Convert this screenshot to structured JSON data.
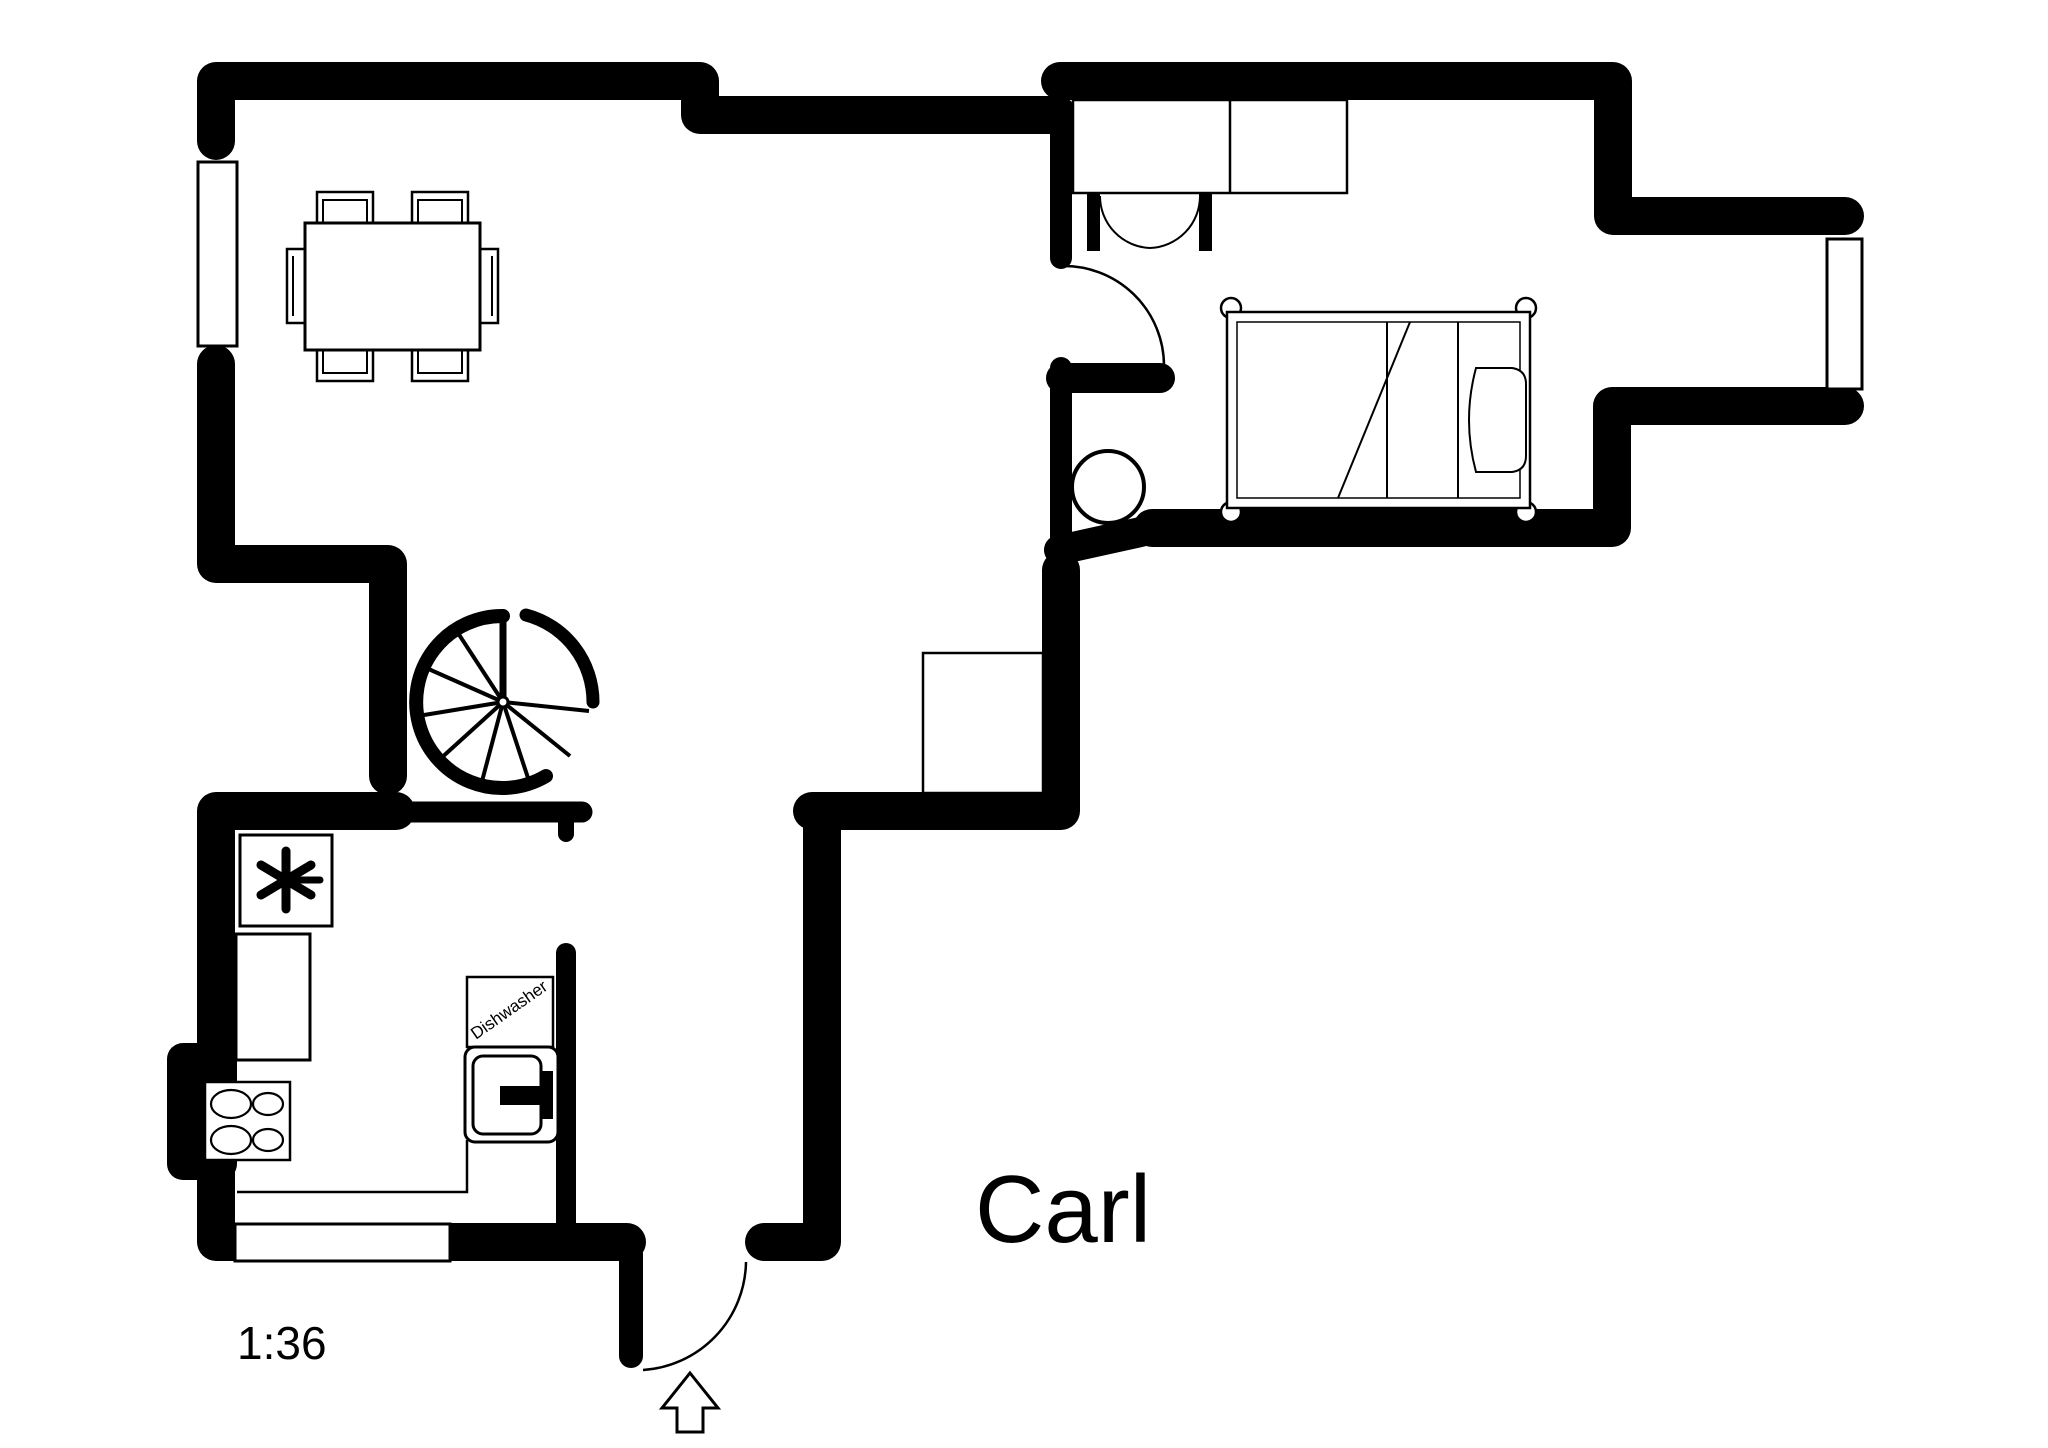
{
  "plan": {
    "title": "Carl",
    "scale": "1:36",
    "dishwasher_label": "Dishwasher",
    "colors": {
      "walls": "#000000",
      "background": "#ffffff"
    },
    "symbols": [
      "dining-table",
      "dining-chairs",
      "spiral-staircase",
      "single-bed",
      "wardrobe-double-doors",
      "round-basin",
      "cooktop-4-burners",
      "freezer-asterisk",
      "dishwasher",
      "entrance-arrow",
      "door-swings",
      "windows"
    ]
  }
}
